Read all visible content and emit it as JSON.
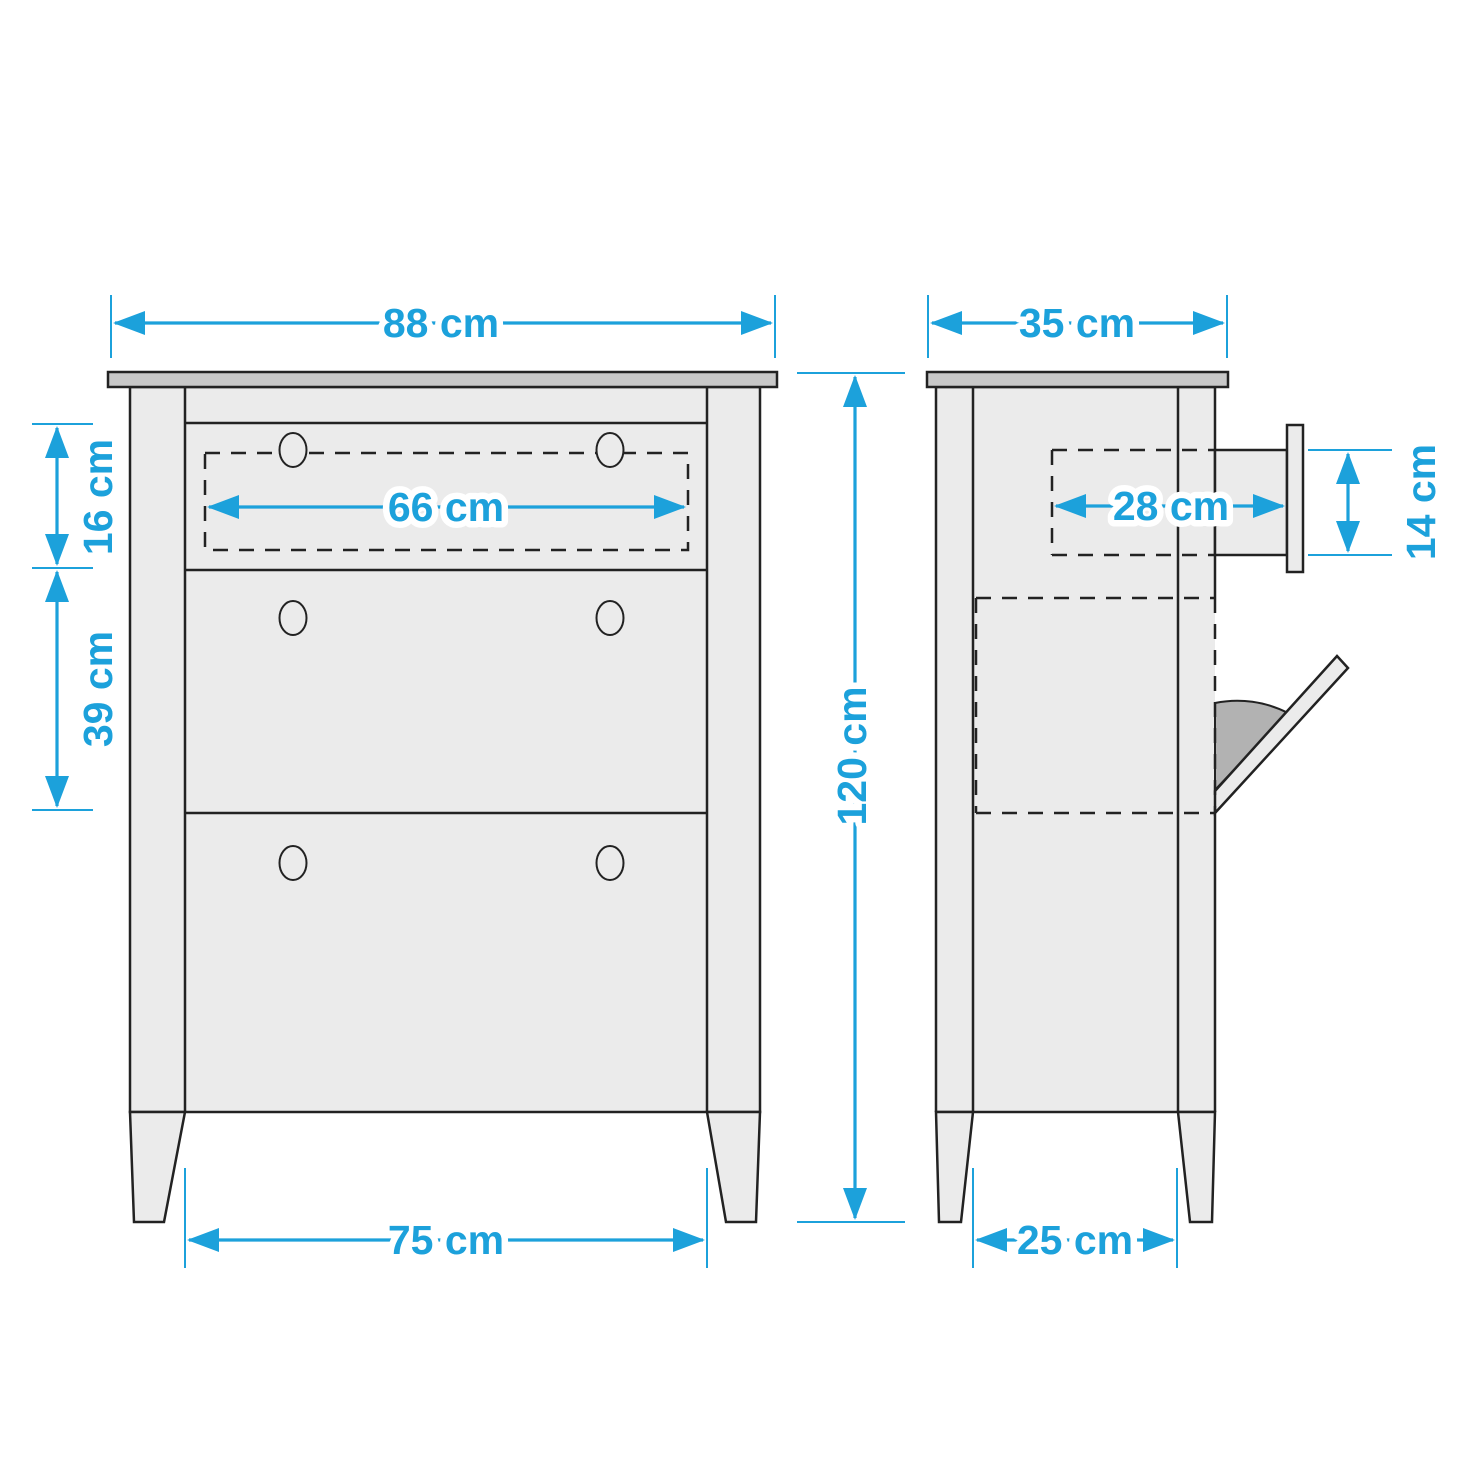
{
  "dimensions": {
    "cabinet_width": {
      "label": "88 cm"
    },
    "cabinet_depth": {
      "label": "35 cm"
    },
    "drawer_opening_width": {
      "label": "66 cm"
    },
    "top_drawer_height": {
      "label": "16 cm"
    },
    "flap_compartment_height": {
      "label": "39 cm"
    },
    "cabinet_height": {
      "label": "120 cm"
    },
    "drawer_pullout_depth": {
      "label": "28 cm"
    },
    "drawer_side_height": {
      "label": "14 cm"
    },
    "front_leg_spacing": {
      "label": "75 cm"
    },
    "side_leg_spacing": {
      "label": "25 cm"
    }
  },
  "colors": {
    "accent_blue": "#1ca1db",
    "outline": "#222222",
    "body_fill": "#ebebeb",
    "tabletop_fill": "#c8c8c8",
    "swing_shade_fill": "#b2b2b2",
    "background": "#ffffff"
  }
}
